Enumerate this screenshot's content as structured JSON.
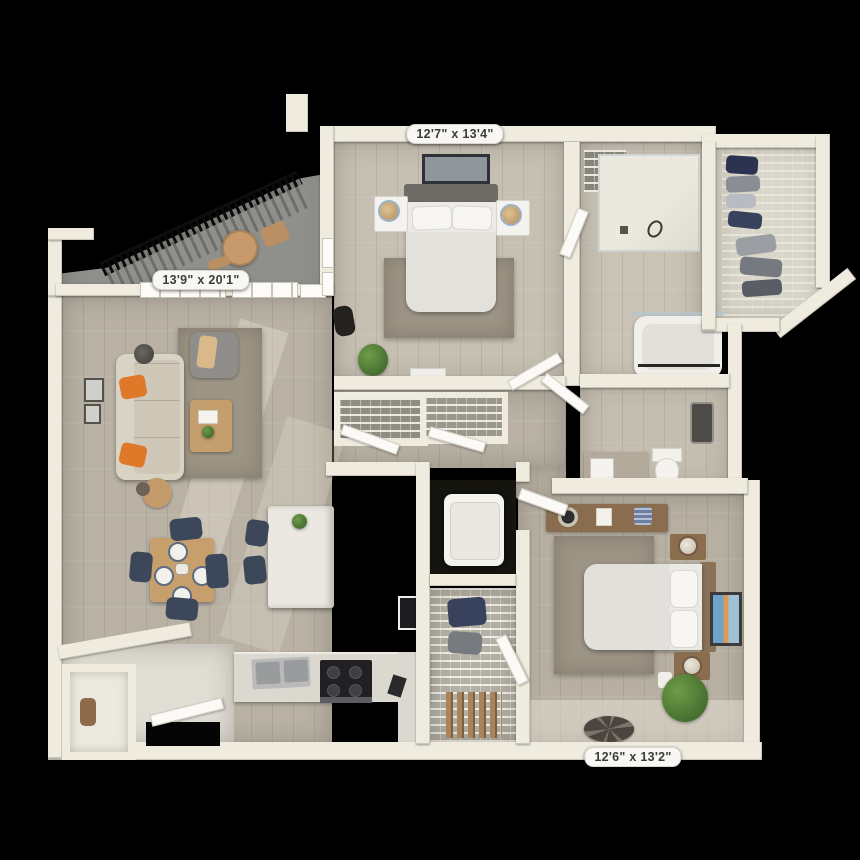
{
  "labels": {
    "bedroom1": "12'7\" x 13'4\"",
    "living": "13'9\" x 20'1\"",
    "bedroom2": "12'6\" x 13'2\""
  },
  "palette": {
    "background": "#000000",
    "wall": "#efecdf",
    "wood_a": "#c6c0b3",
    "wood_b": "#b8b1a4",
    "wood_c": "#b7b0a2",
    "rug": "#9c9484",
    "balcony_floor": "#8f8f8b",
    "label_bg": "#f8f7f3",
    "label_text": "#3c3c3c",
    "accent_orange": "#e0782a",
    "accent_navy": "#3c4759",
    "furniture_brown": "#8a6c4e",
    "plant_green": "#46702f",
    "counter": "#dbd8cf",
    "appliance_dark": "#212124"
  }
}
